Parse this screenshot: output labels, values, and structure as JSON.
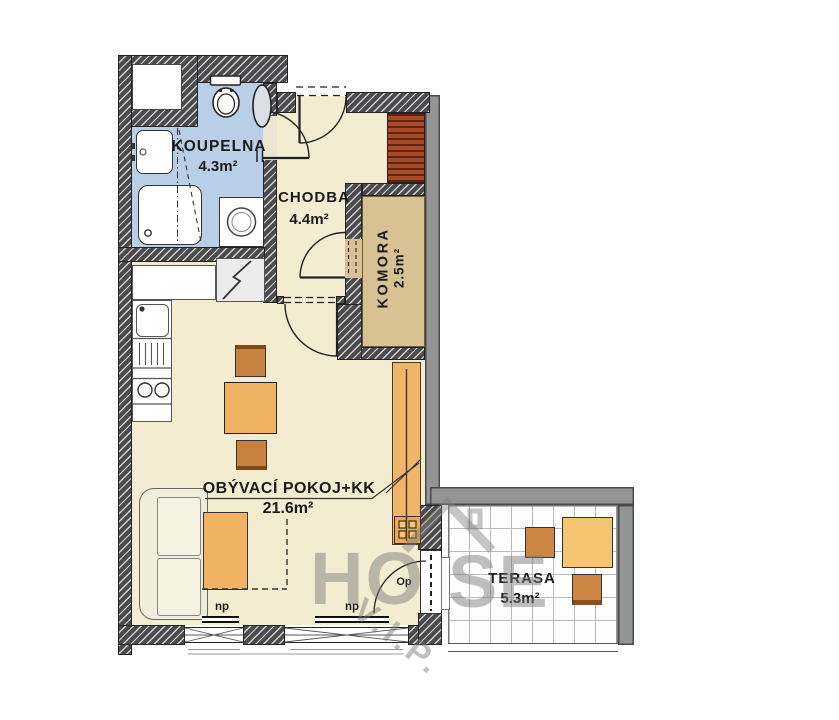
{
  "title": "Apartment floor plan",
  "rooms": {
    "koupelna": {
      "name": "KOUPELNA",
      "area": "4.3m²"
    },
    "chodba": {
      "name": "CHODBA",
      "area": "4.4m²"
    },
    "komora": {
      "name": "KOMORA",
      "area": "2.5m²"
    },
    "obyvaci_pokoj": {
      "name": "OBÝVACÍ POKOJ+KK",
      "area": "21.6m²"
    },
    "terasa": {
      "name": "TERASA",
      "area": "5.3m²"
    }
  },
  "markers": {
    "window_label": "np",
    "balcony_door_label": "Op"
  },
  "watermark": {
    "part1": "HO",
    "part2": "SE",
    "vip": "V.I.P."
  },
  "icons": {
    "toilet": "toilet-icon",
    "bath_sink": "sink-icon",
    "shower": "shower-icon",
    "washing_machine": "washing-machine-icon",
    "boiler": "boiler-icon",
    "kitchen_sink": "kitchen-sink-icon",
    "stove": "stove-icon",
    "electric_panel": "electric-panel-icon",
    "house_logo": "house-roof-icon"
  },
  "colors": {
    "wall_hatched": "#4b4b4d",
    "wall_outer_gray": "#939494",
    "bathroom_floor": "#b9cfe8",
    "room_floor": "#f3ecd1",
    "komora_floor": "#d8c192",
    "furniture_orange": "#f2b264",
    "furniture_dark_orange": "#c8813e",
    "wardrobe_red": "#a84a28",
    "watermark_gray": "#b5b5b5"
  }
}
